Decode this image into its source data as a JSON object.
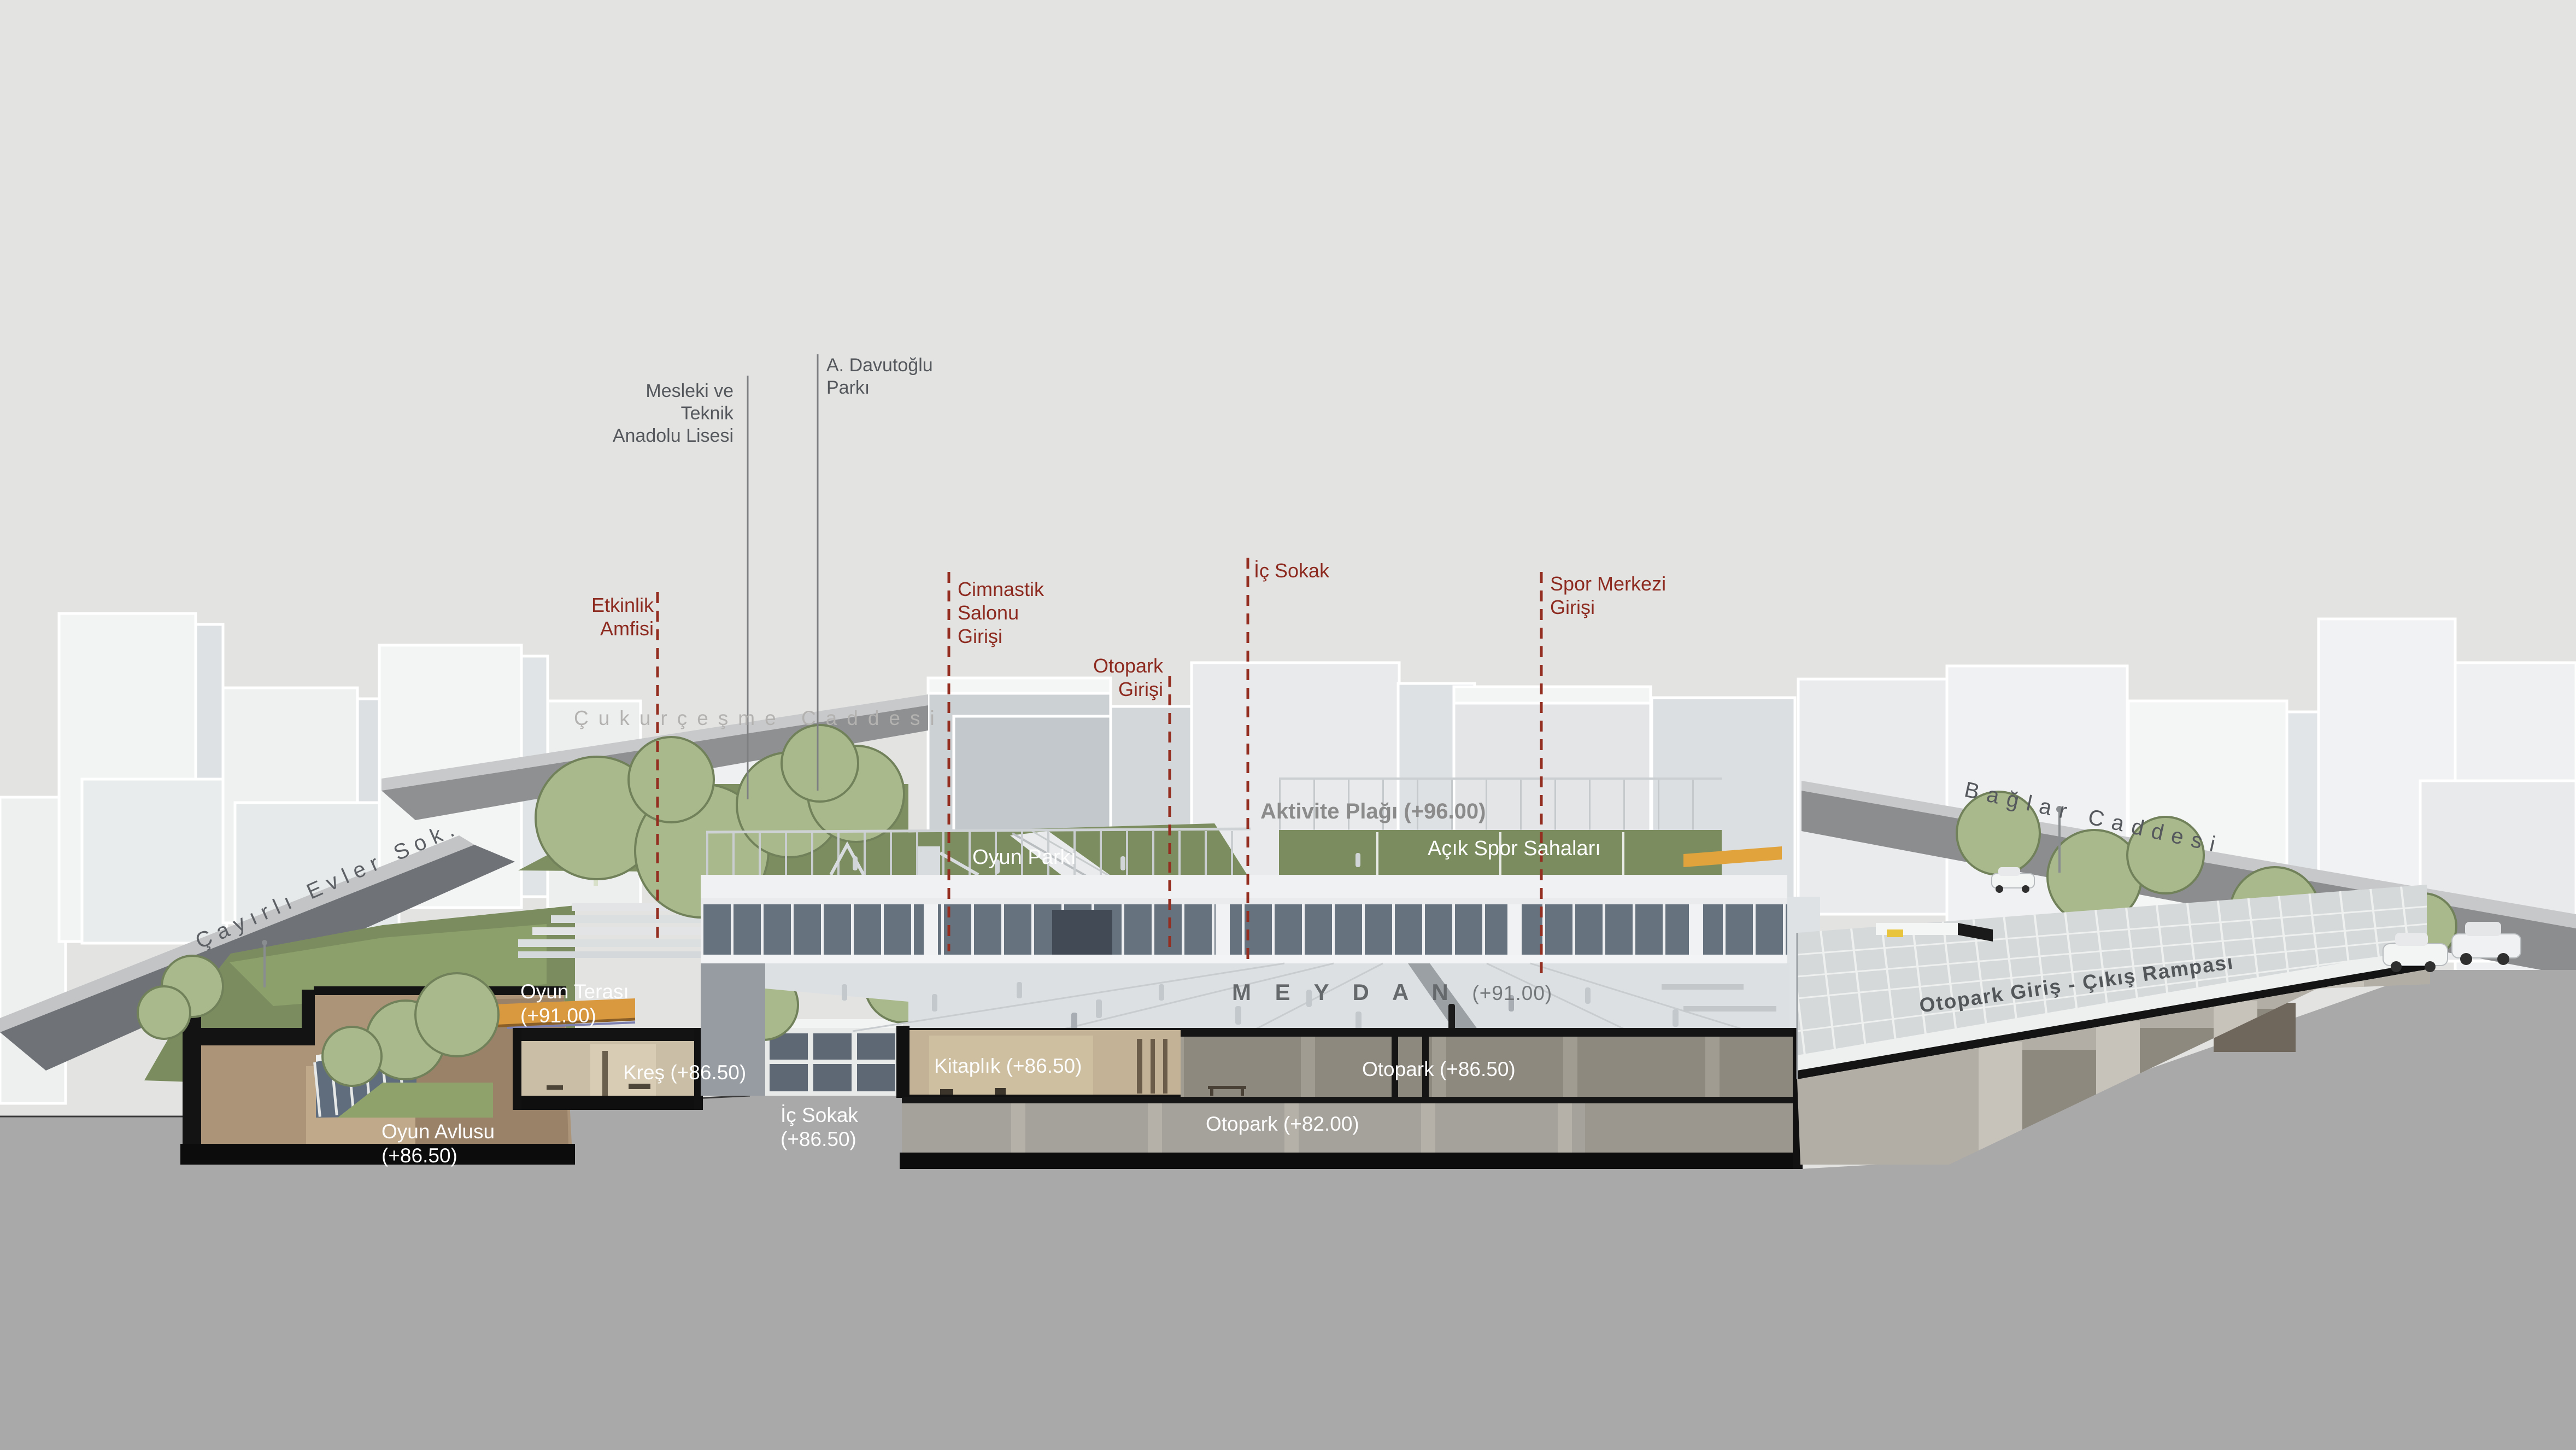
{
  "title": "Architectural section-perspective diagram with Turkish program labels",
  "colors": {
    "background": "#e3e3e2",
    "foreground_ground": "#a9a9a9",
    "accent_red": "#8e2b20",
    "red_dashed_line": "#942e20",
    "label_dark_gray": "#55585c",
    "label_light_gray": "#b3b2b0",
    "label_white": "#fdfdfd",
    "aktivite_gray": "#8b8b8b",
    "green_dark": "#7b8d5e",
    "green_light": "#a9b98c",
    "glass_blue": "#67727f",
    "interior_beige": "#c3b295",
    "interior_tan": "#ab9478",
    "wood_orange": "#d9993f",
    "section_black": "#131313",
    "road_dark": "#6f7276",
    "road_mid": "#8e9092",
    "building_white": "#f2f3f3",
    "parking_upper": "#8e897f",
    "parking_lower": "#a5a29b",
    "ramp_grid_wall": "#d6d9da"
  },
  "annotations": {
    "mesleki_lisesi": {
      "text": "Mesleki ve\nTeknik\nAnadolu Lisesi"
    },
    "davutoglu_parki": {
      "text": "A. Davutoğlu\nParkı"
    },
    "etkinlik_amfisi": {
      "text": "Etkinlik\nAmfisi"
    },
    "cimnastik_girisi": {
      "text": "Cimnastik\nSalonu\nGirişi"
    },
    "otopark_girisi": {
      "text": "Otopark\nGirişi"
    },
    "ic_sokak_ust": {
      "text": "İç Sokak"
    },
    "spor_merkezi_girisi": {
      "text": "Spor Merkezi\nGirişi"
    },
    "cukurcesme_caddesi": {
      "text": "Çukurçeşme Caddesi"
    },
    "baglar_caddesi": {
      "text": "Bağlar Caddesi"
    },
    "cayirli_evler_sok": {
      "text": "Çayırlı Evler Sok."
    },
    "aktivite_plagi": {
      "text": "Aktivite Plağı (+96.00)"
    },
    "oyun_parki": {
      "text": "Oyun Parkı"
    },
    "acik_spor_sahalari": {
      "text": "Açık Spor Sahaları"
    },
    "oyun_terasi": {
      "text": "Oyun Terası\n(+91.00)"
    },
    "meydan": {
      "title": "M E Y D A N",
      "level": "(+91.00)"
    },
    "kres": {
      "text": "Kreş (+86.50)"
    },
    "kitaplik": {
      "text": "Kitaplık (+86.50)"
    },
    "otopark_86": {
      "text": "Otopark  (+86.50)"
    },
    "ic_sokak_alt": {
      "text": "İç Sokak\n(+86.50)"
    },
    "oyun_avlusu": {
      "text": "Oyun Avlusu\n(+86.50)"
    },
    "otopark_82": {
      "text": "Otopark (+82.00)"
    },
    "rampa": {
      "text": "Otopark Giriş - Çıkış Rampası"
    }
  }
}
